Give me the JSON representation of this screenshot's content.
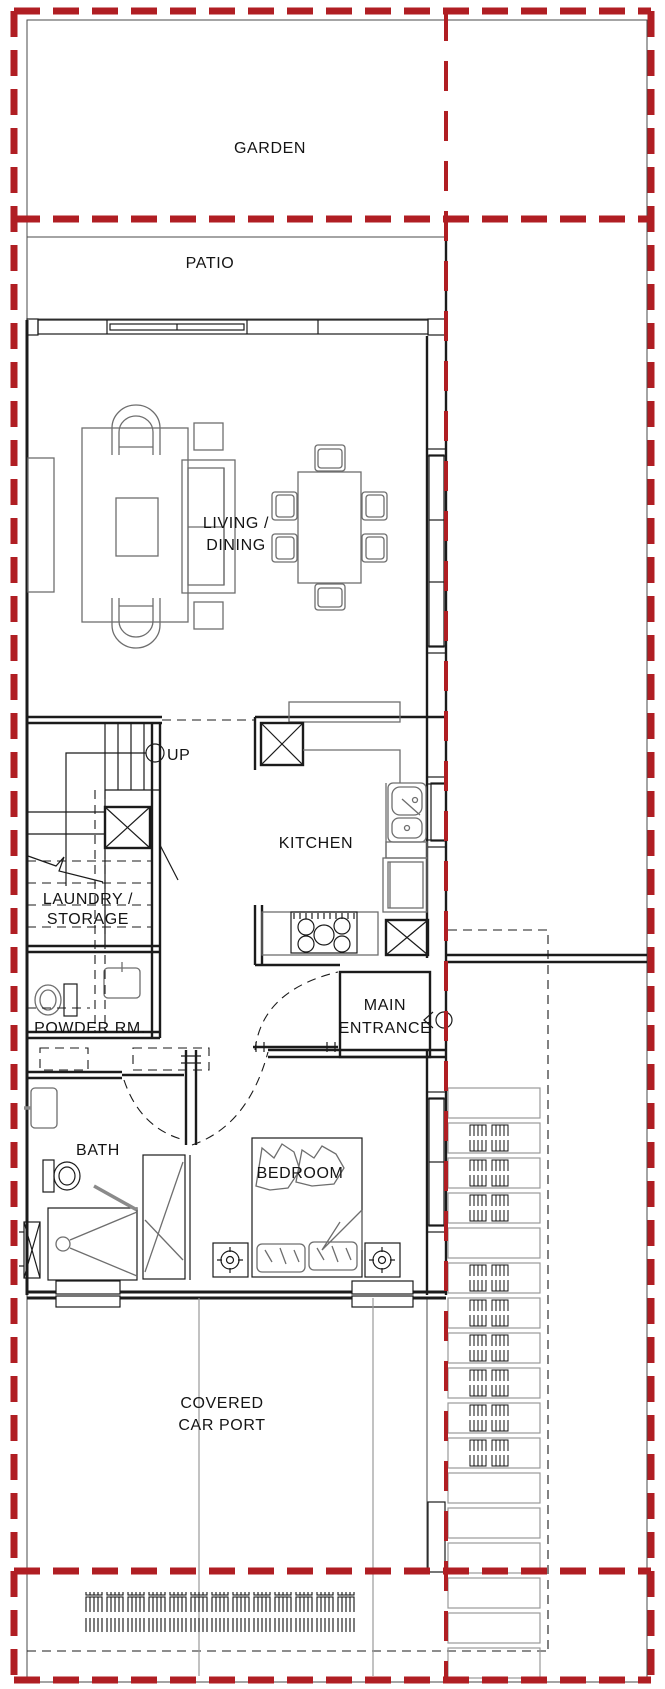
{
  "document": {
    "type": "architectural-floor-plan",
    "background": "#ffffff"
  },
  "colors": {
    "boundary_red": "#b01e23",
    "wall_black": "#1b1b1b",
    "furniture_gray": "#6e6e6e",
    "site_line_gray": "#4a4a4a",
    "label_text": "#141414"
  },
  "labels": {
    "garden": "GARDEN",
    "patio": "PATIO",
    "living_line1": "LIVING /",
    "living_line2": "DINING",
    "kitchen": "KITCHEN",
    "stairs_up": "UP",
    "laundry_line1": "LAUNDRY /",
    "laundry_line2": "STORAGE",
    "powder_room": "POWDER RM.",
    "entrance_line1": "MAIN",
    "entrance_line2": "ENTRANCE",
    "bath": "BATH",
    "bedroom": "BEDROOM",
    "carport_line1": "COVERED",
    "carport_line2": "CAR PORT"
  }
}
